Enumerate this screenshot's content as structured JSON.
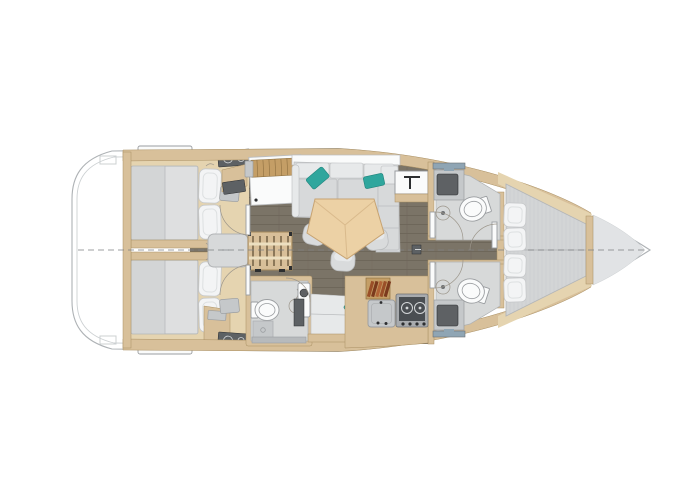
{
  "meta": {
    "title": "sailboat-interior-floor-plan",
    "view": "top-down deck layout illustration",
    "orientation": "bow-right-stern-left",
    "text_content": "none (drawing only)"
  },
  "palette": {
    "hull_line": "#aeb2b5",
    "sheer": "#ccd0d2",
    "deck": "#e1e3e5",
    "floor": "#7b7467",
    "floor_line": "#6a6356",
    "wood": "#d8c09a",
    "wood_dark": "#a98f62",
    "wood_light": "#e5d4b0",
    "wood_slat": "#c49e66",
    "slat_line": "#8e7040",
    "mattress": "#d3d5d6",
    "mattress_light": "#dedfe0",
    "mattress_edge": "#b4b6b8",
    "quilt": "#c9cbcd",
    "pillow": "#f3f4f5",
    "pillow_edge": "#c6c8ca",
    "pillow_crease": "#dde0e1",
    "sofa": "#d7d9da",
    "sofa_light": "#e7e9ea",
    "sofa_edge": "#bbbdbf",
    "teal": "#2fa69d",
    "teal_dark": "#20837b",
    "table": "#ecd1a5",
    "table_edge": "#c7a372",
    "table_seam": "#d9ba8c",
    "stool": "#d9dbdc",
    "bath": "#d7d9d9",
    "bath_edge": "#aeb1b3",
    "fixture": "#9a9da0",
    "white": "#fafbfb",
    "steel": "#c5c8ca",
    "steel_dark": "#6d7073",
    "basin": "#5e6164",
    "stove_frame": "#a8abae",
    "stove": "#4a4e52",
    "burner": "#d3d6d8",
    "engine": "#d7d9da",
    "engine_edge": "#b1b3b5",
    "ladder": "#d8bf99",
    "ladder_edge": "#a3885c",
    "ladder_slat": "#6b5a3e",
    "ladder_light": "#ecdfc0",
    "arc": "#9c968b",
    "centerline": "#7d8083",
    "black": "#2c2e30",
    "books_a": "#9a4f28",
    "books_b": "#7b3a1d",
    "books_c": "#b16336",
    "faucet": "#8fa5b4",
    "dark_unit": "#5d6164",
    "bar": "#b7babc"
  },
  "components": [
    "hull",
    "transom-platform",
    "stern-steps",
    "centerline",
    "aft-cabin-starboard",
    "aft-cabin-port",
    "double-berth",
    "berth-pillows",
    "cabin-vanity",
    "cabin-seat",
    "cabin-desk",
    "engine-compartment",
    "companionway-ladder",
    "salon-floor",
    "nav-station",
    "chart-table",
    "l-shaped-settee",
    "teal-accent-pillows",
    "dinette-table",
    "stools",
    "wet-bar",
    "aft-head",
    "toilet",
    "shower",
    "shower-tray",
    "vanity-sink",
    "bench-seat",
    "galley",
    "bookshelf",
    "galley-sink-panel",
    "stove",
    "forward-head-starboard",
    "forward-head-port",
    "head-sink",
    "corridor",
    "forward-cabin",
    "v-berth",
    "v-berth-pillows",
    "bow-deck",
    "door-swing-arcs",
    "floor-hatch"
  ]
}
